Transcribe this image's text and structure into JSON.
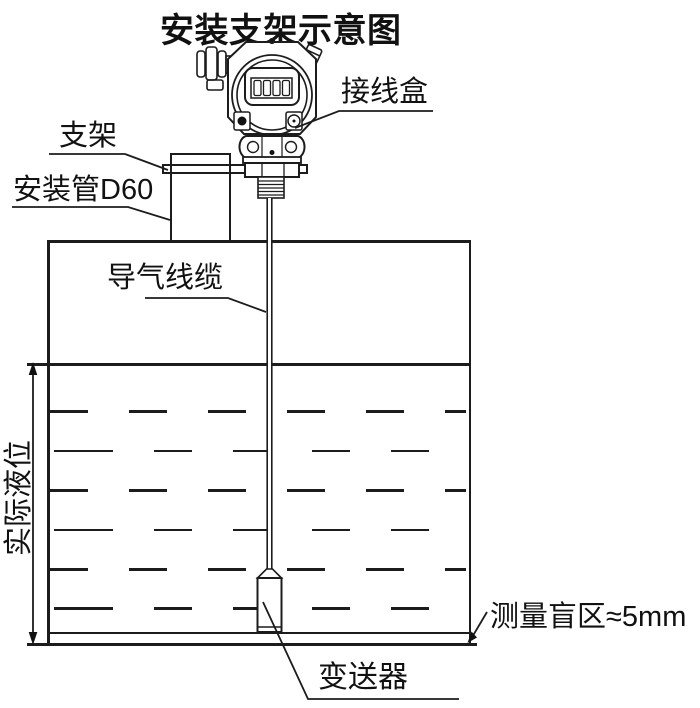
{
  "title": "安装支架示意图",
  "colors": {
    "line": "#1c1c1c",
    "text": "#111111",
    "background": "#ffffff"
  },
  "labels": {
    "junction_box": "接线盒",
    "bracket": "支架",
    "mounting_pipe": "安装管D60",
    "air_cable": "导气线缆",
    "actual_level": "实际液位",
    "blind_zone": "测量盲区≈5mm",
    "transmitter": "变送器"
  }
}
